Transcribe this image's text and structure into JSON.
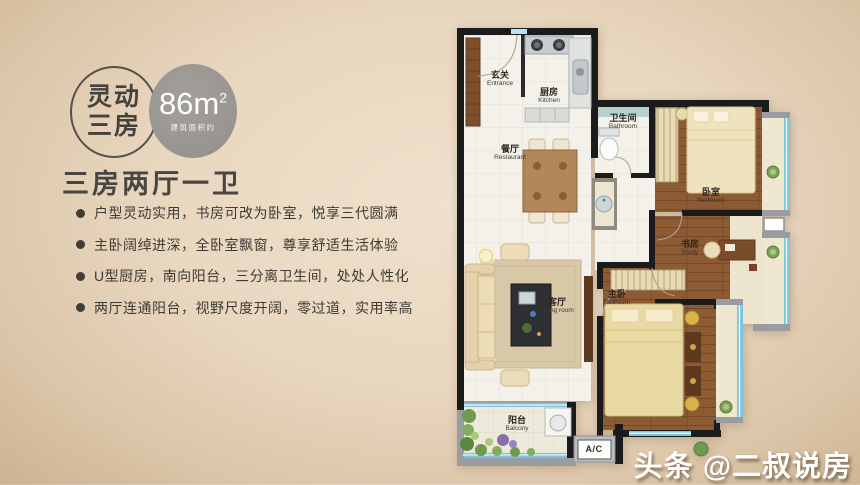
{
  "badges": {
    "type_line1": "灵动",
    "type_line2": "三房",
    "area_value": "86",
    "area_unit": "m",
    "area_sup": "2",
    "area_note": "建筑面积约"
  },
  "heading": "三房两厅一卫",
  "features": [
    "户型灵动实用，书房可改为卧室，悦享三代圆满",
    "主卧阔绰进深，全卧室飘窗，尊享舒适生活体验",
    "U型厨房，南向阳台，三分离卫生间，处处人性化",
    "两厅连通阳台，视野尺度开阔，零过道，实用率高"
  ],
  "floorplan": {
    "rooms": [
      {
        "zh": "玄关",
        "en": "Entrance"
      },
      {
        "zh": "厨房",
        "en": "Kitchen"
      },
      {
        "zh": "卫生间",
        "en": "Bathroom"
      },
      {
        "zh": "餐厅",
        "en": "Restaurant"
      },
      {
        "zh": "卧室",
        "en": "Bedroom"
      },
      {
        "zh": "书房",
        "en": "Study"
      },
      {
        "zh": "客厅",
        "en": "Living room"
      },
      {
        "zh": "主卧",
        "en": "Bedroom"
      },
      {
        "zh": "阳台",
        "en": "Balcony"
      }
    ],
    "ac_label": "A/C"
  },
  "watermark": "头条 @二叔说房",
  "colors": {
    "background_beige": "#e9d7c0",
    "badge_gray": "#9a9691",
    "wall_black": "#1b1b1b",
    "window_blue": "#7cc5de",
    "wood_brown": "#8c5a33",
    "text_dark": "#3e3b35",
    "watermark_white": "#ffffff"
  }
}
